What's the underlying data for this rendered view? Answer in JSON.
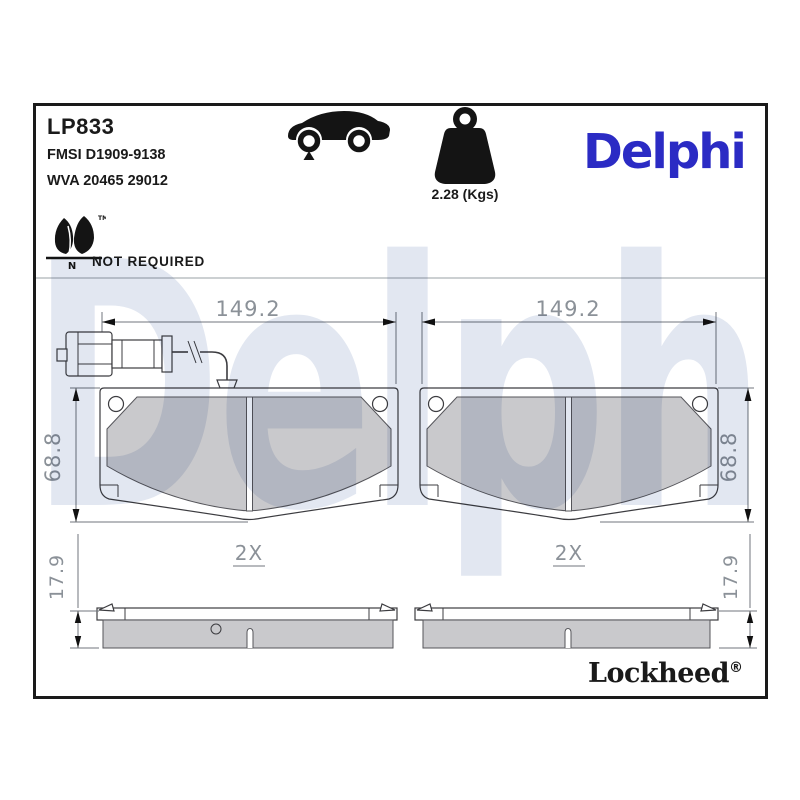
{
  "header": {
    "product_code": "LP833",
    "fmsi_ref": "FMSI D1909-9138",
    "wva_ref": "WVA 20465 29012",
    "weight": "2.28 (Kgs)",
    "brand_logo": "Delphi",
    "copper_leafmark": {
      "tm": "TM",
      "n": "N",
      "status": "NOT REQUIRED"
    }
  },
  "watermark": "Delphi",
  "drawings": {
    "left_pad": {
      "width": "149.2",
      "height": "68.8",
      "quantity": "2X",
      "thickness": "17.9"
    },
    "right_pad": {
      "width": "149.2",
      "height": "68.8",
      "quantity": "2X",
      "thickness": "17.9"
    }
  },
  "footer": {
    "brand": "Lockheed",
    "registered_mark": "®"
  },
  "colors": {
    "brand_blue": "#2b2bc4",
    "watermark_blue": "#e2e7f1",
    "friction_gray": "#c9c9cc",
    "dimension_gray": "#8b9198",
    "ink": "#1a1a1a"
  }
}
